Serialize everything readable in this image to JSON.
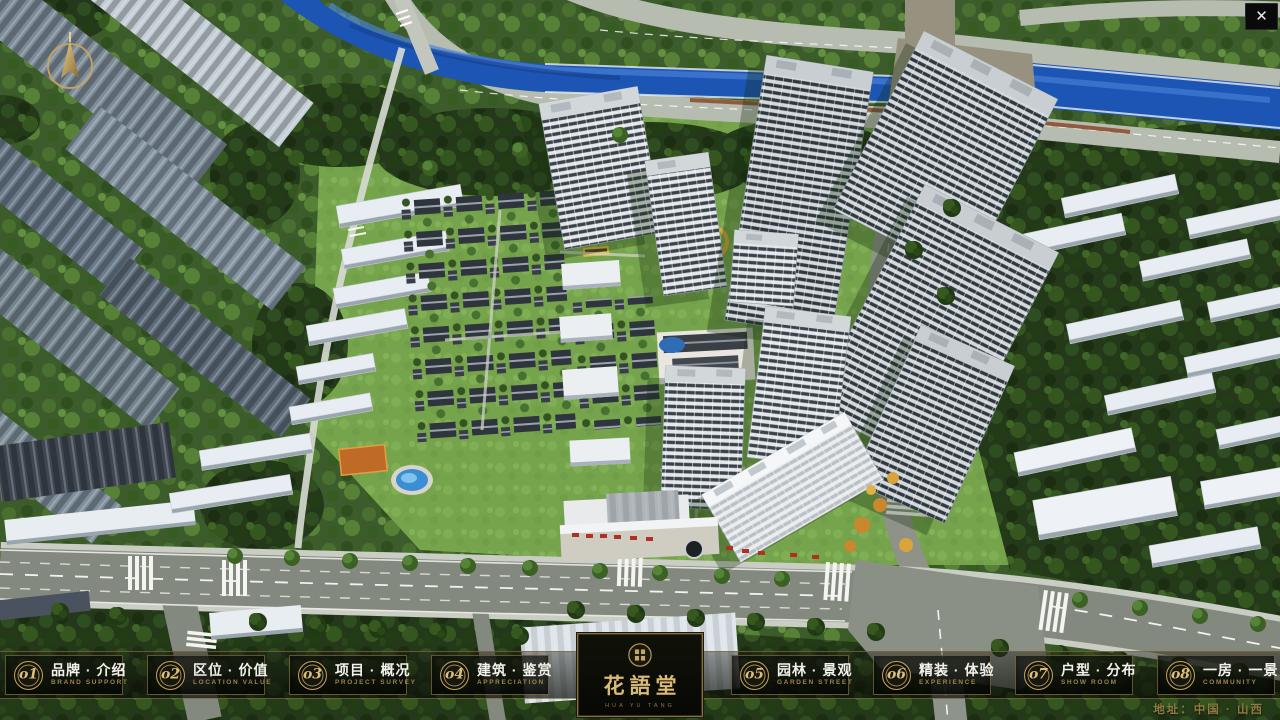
{
  "window": {
    "close_button": "✕"
  },
  "brand": {
    "title": "花語堂",
    "subtitle": "HUA YU TANG"
  },
  "nav": {
    "left_items": [
      {
        "no": "o1",
        "cn": "品牌 · 介绍",
        "en": "BRAND SUPPORT"
      },
      {
        "no": "o2",
        "cn": "区位 · 价值",
        "en": "LOCATION VALUE"
      },
      {
        "no": "o3",
        "cn": "项目 · 概况",
        "en": "PROJECT SURVEY"
      },
      {
        "no": "o4",
        "cn": "建筑 · 鉴赏",
        "en": "APPRECIATION"
      }
    ],
    "right_items": [
      {
        "no": "o5",
        "cn": "园林 · 景观",
        "en": "GARDEN STREET"
      },
      {
        "no": "o6",
        "cn": "精装 · 体验",
        "en": "EXPERIENCE"
      },
      {
        "no": "o7",
        "cn": "户型 · 分布",
        "en": "SHOW ROOM"
      },
      {
        "no": "o8",
        "cn": "一房 · 一景",
        "en": "COMMUNITY"
      }
    ]
  },
  "footer": {
    "address": "地址：中国 · 山西"
  },
  "icons": {
    "compass": "compass-icon",
    "close": "close-icon",
    "seal": "brand-seal-icon"
  },
  "colors": {
    "gold": "#c8a566",
    "gold-dim": "#9b8450",
    "panel": "#0b0d08",
    "text": "#f2f1ea"
  }
}
